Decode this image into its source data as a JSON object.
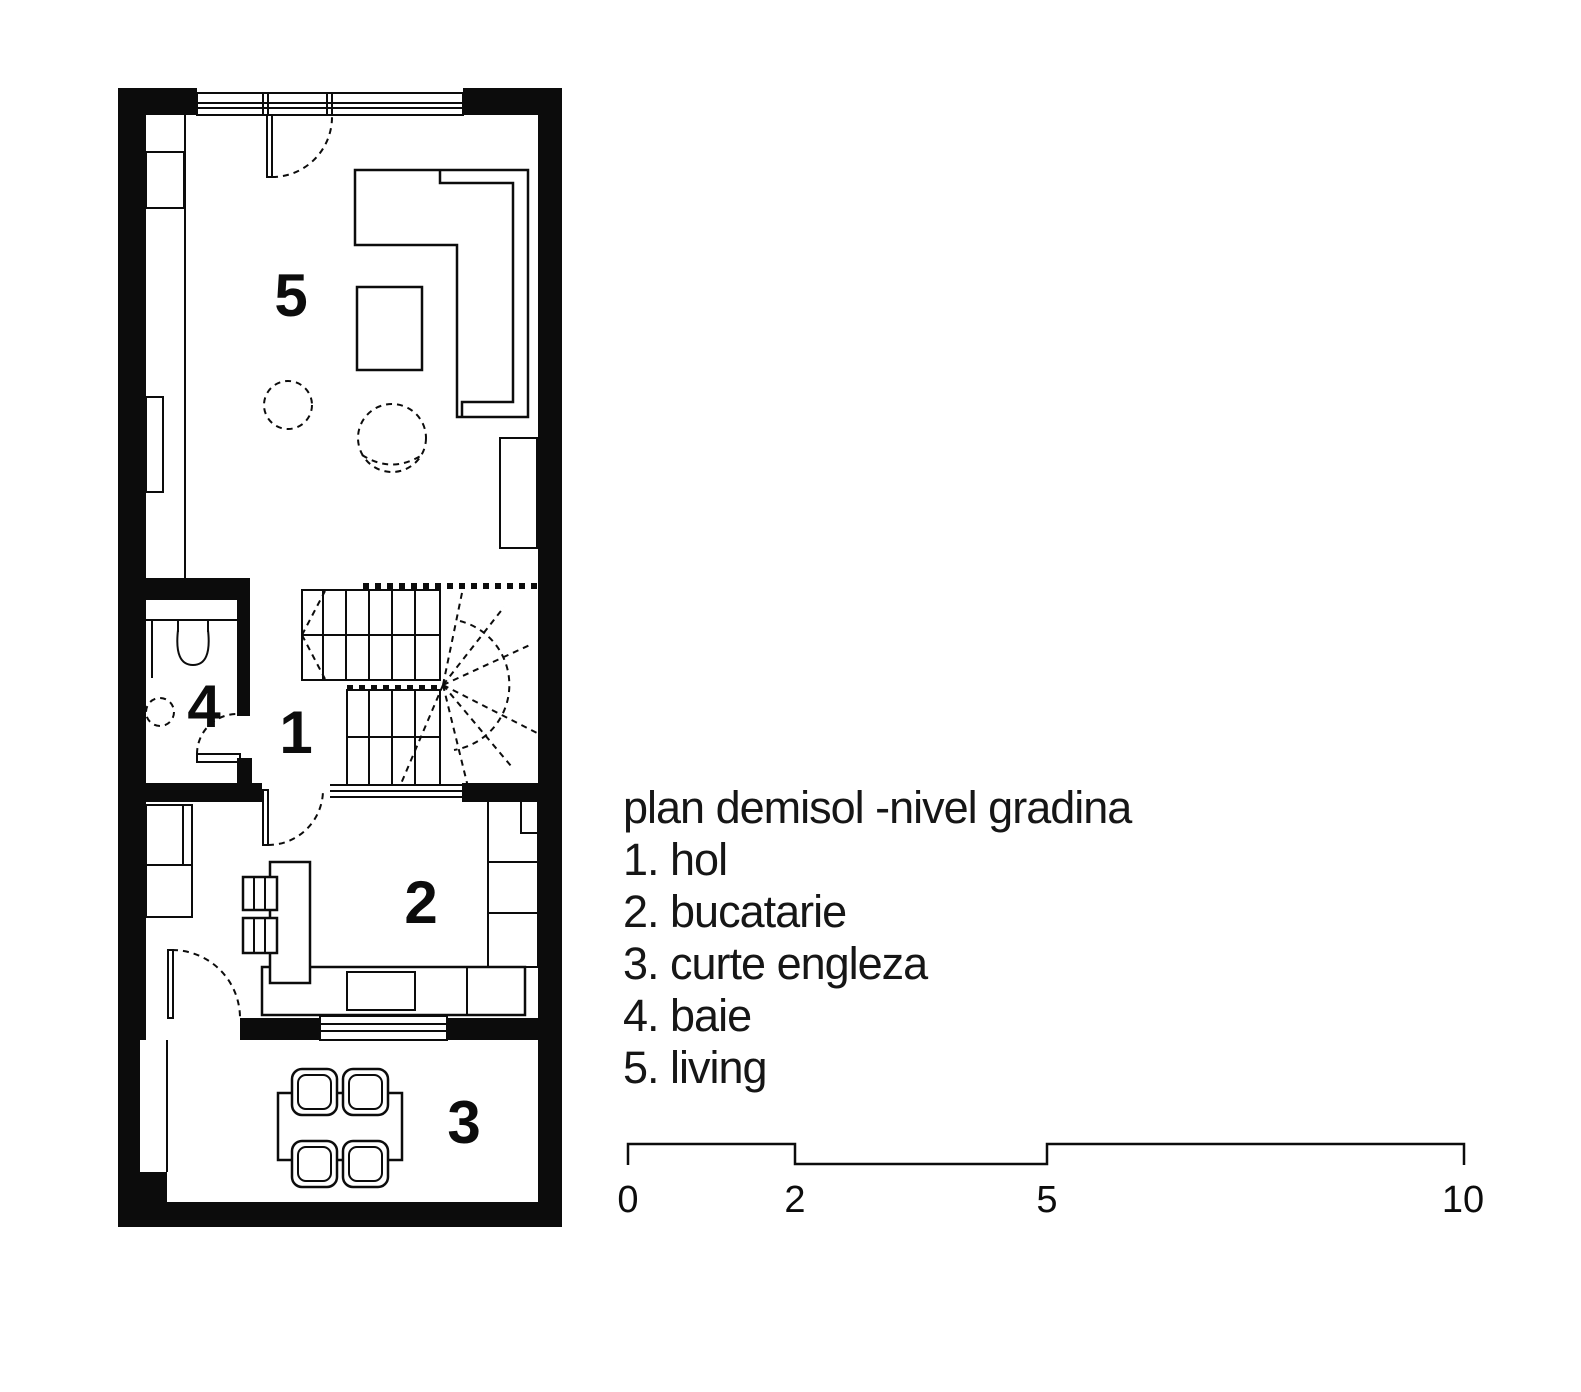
{
  "page": {
    "background": "#ffffff",
    "ink": "#0c0c0c",
    "drawing_type": "architectural floor plan"
  },
  "plan": {
    "rooms": [
      {
        "number": "1",
        "name": "hol"
      },
      {
        "number": "2",
        "name": "bucatarie"
      },
      {
        "number": "3",
        "name": "curte engleza"
      },
      {
        "number": "4",
        "name": "baie"
      },
      {
        "number": "5",
        "name": "living"
      }
    ]
  },
  "legend": {
    "title": "plan demisol -nivel gradina",
    "items": [
      "1. hol",
      "2. bucatarie",
      "3. curte engleza",
      "4. baie",
      "5. living"
    ]
  },
  "scalebar": {
    "labels": [
      "0",
      "2",
      "5",
      "10"
    ]
  }
}
